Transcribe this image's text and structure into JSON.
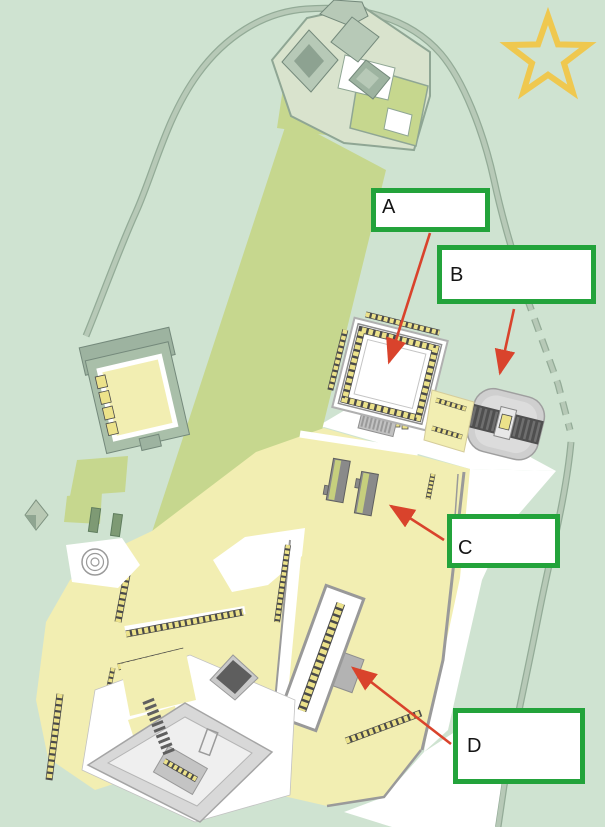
{
  "map": {
    "type": "archaeological-site-plan",
    "palette": {
      "terrain_green": "#cfe3d1",
      "field_olive": "#c6d78e",
      "courtyard_yellow": "#f2eeb2",
      "column_base_yellow": "#ece28a",
      "road_fill": "#b7c9b7",
      "road_edge": "#93ab97",
      "wall_gray": "#9a9a9a",
      "structure_gray": "#cfcfcf",
      "ramp_dark_gray": "#575757",
      "roof_green": "#a9bfa9",
      "path_white": "#ffffff"
    },
    "features": {
      "a_target": "walled courtyard compound with column bases",
      "b_target": "gray gate mound with ramp",
      "c_target": "twin parallel platforms in courtyard",
      "d_target": "long pillared hall"
    }
  },
  "annotations": {
    "box_border_color": "#23a33b",
    "arrow_color": "#d9432c",
    "labels": [
      {
        "id": "A",
        "letter": "A"
      },
      {
        "id": "B",
        "letter": "B"
      },
      {
        "id": "C",
        "letter": "C"
      },
      {
        "id": "D",
        "letter": "D"
      }
    ]
  },
  "decorations": {
    "star": {
      "icon": "five-pointed-star-outline",
      "color": "#efc84f"
    }
  }
}
